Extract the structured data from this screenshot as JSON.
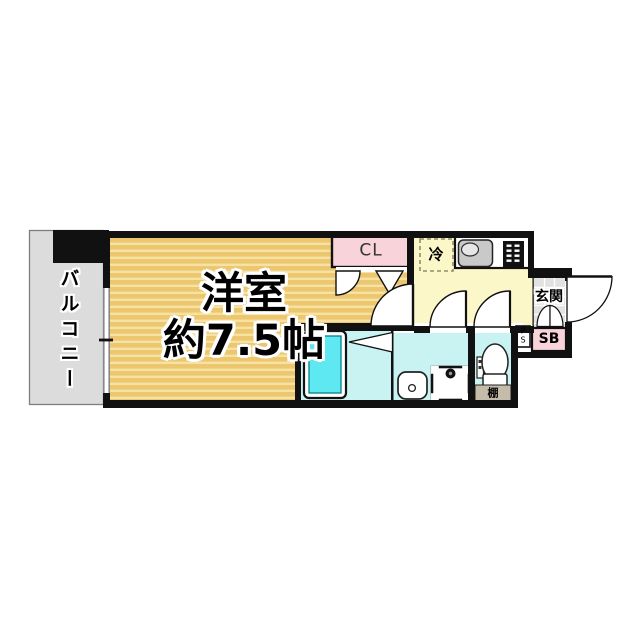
{
  "plan": {
    "balcony": {
      "label": "バルコニー"
    },
    "main_room": {
      "name": "洋室",
      "size": "約7.5帖"
    },
    "closet": {
      "label": "CL"
    },
    "refrigerator": {
      "label": "冷"
    },
    "entrance": {
      "label": "玄関"
    },
    "shoe_box": {
      "label": "SB"
    },
    "pipe_space": {
      "line1": "P",
      "line2": "S"
    },
    "shelf": {
      "label": "棚"
    },
    "colors": {
      "wall": "#111111",
      "room_floor": "#ecc76f",
      "room_floor_stripe": "#f6e3a4",
      "kitchen_floor": "#fbf7c9",
      "wet_area_floor": "#c9f2f2",
      "bathtub": "#5ee9f2",
      "closet_fill": "#f9d3da",
      "shoe_box_fill": "#f9d3da",
      "balcony_fill": "#dcdcdc",
      "entrance_tile": "#e2e2e2",
      "shelf_fill": "#c4bba9",
      "background": "#ffffff"
    }
  }
}
